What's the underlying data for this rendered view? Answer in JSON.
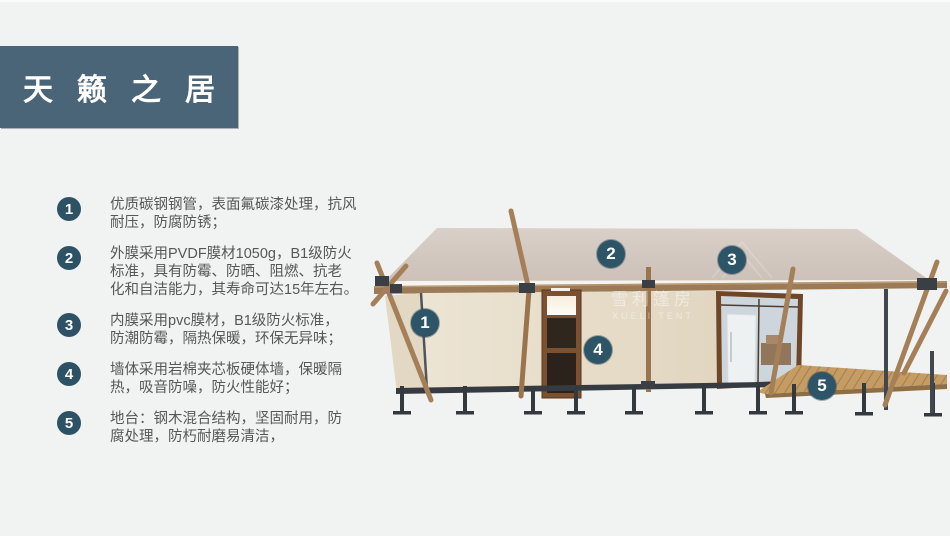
{
  "page": {
    "background": "#f1f2f2",
    "banner": {
      "title": "天籁之居",
      "bg": "#4a6578",
      "text_color": "#ffffff"
    }
  },
  "features": {
    "bullet_color": "#2d5266",
    "text_color": "#575757",
    "items": [
      {
        "number": "1",
        "text": "优质碳钢钢管，表面氟碳漆处理，抗风\n耐压，防腐防锈；"
      },
      {
        "number": "2",
        "text": "外膜采用PVDF膜材1050g，B1级防火\n标准，具有防霉、防晒、阻燃、抗老\n化和自洁能力，其寿命可达15年左右。"
      },
      {
        "number": "3",
        "text": "内膜采用pvc膜材，B1级防火标准，\n防潮防霉，隔热保暖，环保无异味；"
      },
      {
        "number": "4",
        "text": "墙体采用岩棉夹芯板硬体墙，保暖隔\n热，吸音防噪，防火性能好；"
      },
      {
        "number": "5",
        "text": "地台：钢木混合结构，坚固耐用，防\n腐处理，防朽耐磨易清洁，"
      }
    ]
  },
  "image": {
    "description": "3d-render-of-safari-glamping-tent-house",
    "watermark": {
      "line1": "雪利篷房",
      "line2": "XUELI TENT"
    },
    "callouts": [
      {
        "number": "1"
      },
      {
        "number": "2"
      },
      {
        "number": "3"
      },
      {
        "number": "4"
      },
      {
        "number": "5"
      }
    ],
    "colors": {
      "canopy": "#d2c7c0",
      "wall": "#ebe3d3",
      "wood": "#9b7a55",
      "deck": "#c59c64",
      "steel": "#363b42",
      "glass": "#ccd6dc",
      "callout": "#2e5468"
    }
  }
}
